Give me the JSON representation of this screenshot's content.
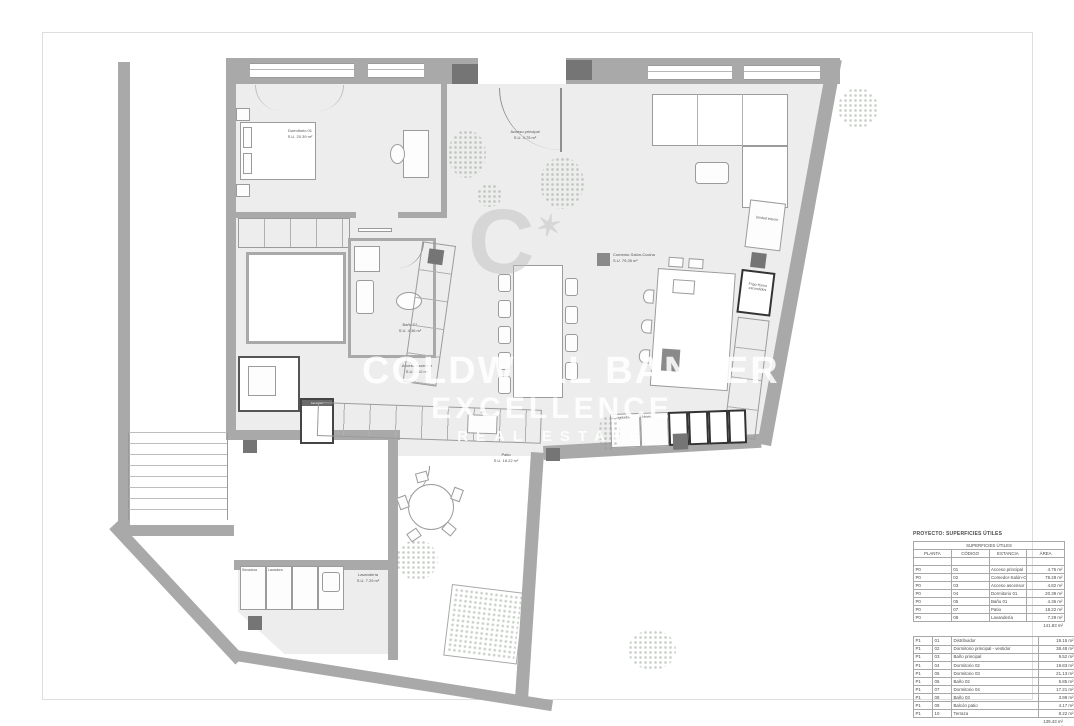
{
  "colors": {
    "wall": "#a9a9a9",
    "floor": "#ededed",
    "column_dark": "#757575",
    "bold_outline": "#333333",
    "label_text": "#555555",
    "watermark": "#ffffff"
  },
  "watermark": {
    "logo_letter": "C",
    "logo_star": "✶",
    "line1": "COLDWELL BANKER",
    "line2": "EXCELLENCE",
    "line3": "REAL ESTATE"
  },
  "plan": {
    "labels": {
      "dormitorio01": {
        "name": "Dormitorio 01",
        "area": "S.U. 20.39 m²"
      },
      "acceso_principal": {
        "name": "Acceso principal",
        "area": "S.U. 4.75 m²"
      },
      "comedor": {
        "name": "Comedor-Salón-Cocina",
        "area": "S.U. 79.28 m²"
      },
      "bano01": {
        "name": "Baño 01",
        "area": "S.U. 4.36 m²"
      },
      "acceso_ascensor": {
        "name": "Acceso ascensor",
        "area": "S.U. 4.82 m²"
      },
      "patio": {
        "name": "Patio",
        "area": "S.U. 18.22 m²"
      },
      "lavanderia": {
        "name": "Lavandería",
        "area": "S.U. 7.29 m²"
      },
      "secadora": "Secadora",
      "lavadora": "Lavadora",
      "congelador": "Congelador",
      "nevera": "Nevera",
      "unidad_interior": "Unidad interior",
      "frigo_horno": "Frigo-Horno escondidos",
      "ascensor": "Ascensor"
    }
  },
  "tables": {
    "project_title": "PROYECTO: SUPERFICIES ÚTILES",
    "table_title": "SUPERFICIES ÚTILES",
    "columns": [
      "PLANTA",
      "CÓDIGO",
      "ESTANCIA",
      "ÁREA"
    ],
    "p0_rows": [
      [
        "P0",
        "01",
        "Acceso principal",
        "4.75 m²"
      ],
      [
        "P0",
        "02",
        "Comedor-Salón-Cocina",
        "79.28 m²"
      ],
      [
        "P0",
        "03",
        "Acceso ascensor",
        "4.82 m²"
      ],
      [
        "P0",
        "04",
        "Dormitorio 01",
        "20.39 m²"
      ],
      [
        "P0",
        "05",
        "Baño 01",
        "4.36 m²"
      ],
      [
        "P0",
        "07",
        "Patio",
        "18.22 m²"
      ],
      [
        "P0",
        "08",
        "Lavandería",
        "7.29 m²"
      ]
    ],
    "p0_total": "141.83 m²",
    "p1_rows": [
      [
        "P1",
        "01",
        "Distribuidor",
        "19.15 m²"
      ],
      [
        "P1",
        "02",
        "Dormitorio principal - vestidor",
        "38.48 m²"
      ],
      [
        "P1",
        "03",
        "Baño principal",
        "9.52 m²"
      ],
      [
        "P1",
        "04",
        "Dormitorio 02",
        "19.83 m²"
      ],
      [
        "P1",
        "05",
        "Dormitorio 03",
        "21.13 m²"
      ],
      [
        "P1",
        "06",
        "Baño 02",
        "5.85 m²"
      ],
      [
        "P1",
        "07",
        "Dormitorio 04",
        "17.21 m²"
      ],
      [
        "P1",
        "08",
        "Baño 03",
        "3.98 m²"
      ],
      [
        "P1",
        "09",
        "Balcón patio",
        "4.17 m²"
      ],
      [
        "P1",
        "10",
        "Terraza",
        "8.22 m²"
      ]
    ],
    "p1_total": "139.43 m²",
    "grand_total": "281.26 m²"
  }
}
